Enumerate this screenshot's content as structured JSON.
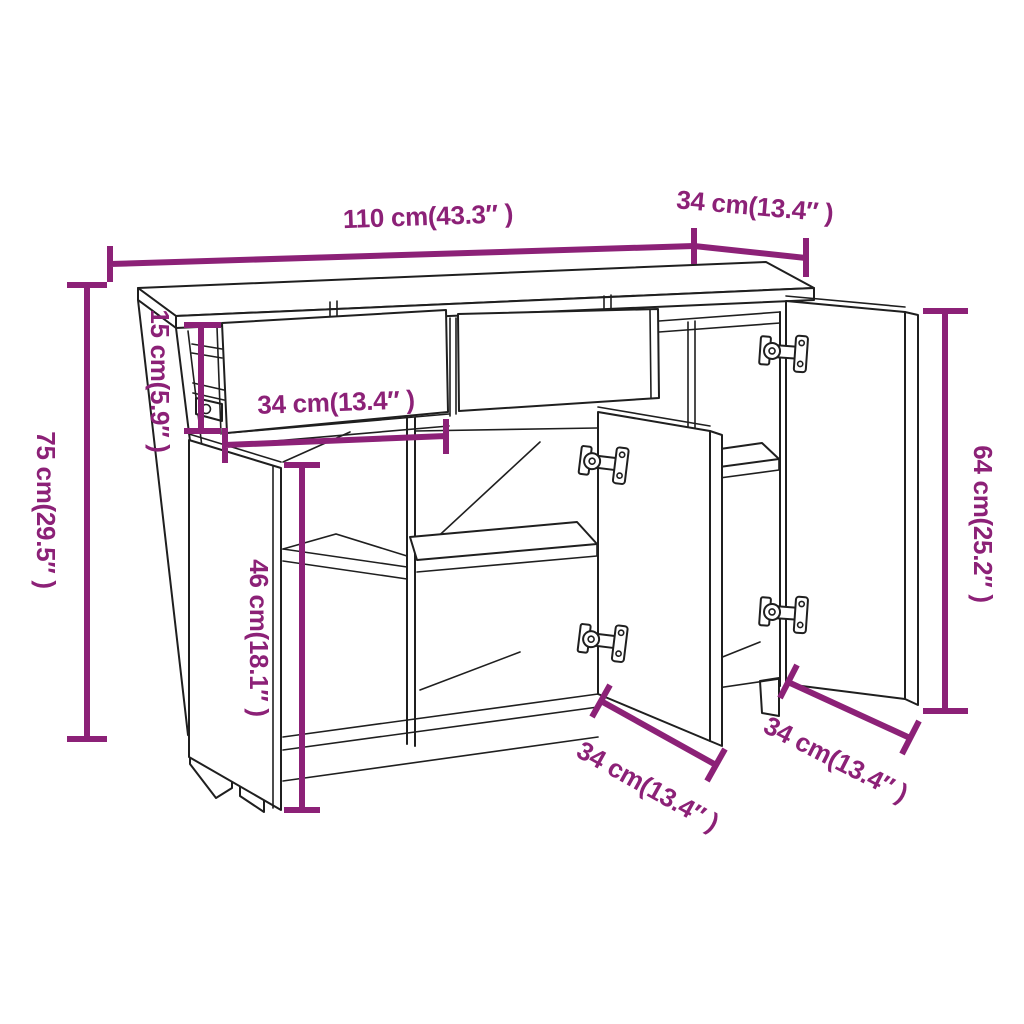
{
  "page": {
    "background": "#ffffff"
  },
  "colors": {
    "dimension_accent": "#8c2177",
    "drawing_line": "#1f1f1f"
  },
  "diagram": {
    "kind": "furniture dimension diagram",
    "subject": "sideboard with two open drawers and three open doors",
    "dimensions": {
      "top_width": "110 cm(43.3″ )",
      "top_depth": "34 cm(13.4″ )",
      "overall_height": "75 cm(29.5″ )",
      "drawer_height": "15 cm(5.9″ )",
      "drawer_width": "34 cm(13.4″ )",
      "interior_height": "46 cm(18.1″ )",
      "right_door_height": "64 cm(25.2″ )",
      "middle_door_width": "34 cm(13.4″ )",
      "right_door_width": "34 cm(13.4″ )"
    }
  }
}
